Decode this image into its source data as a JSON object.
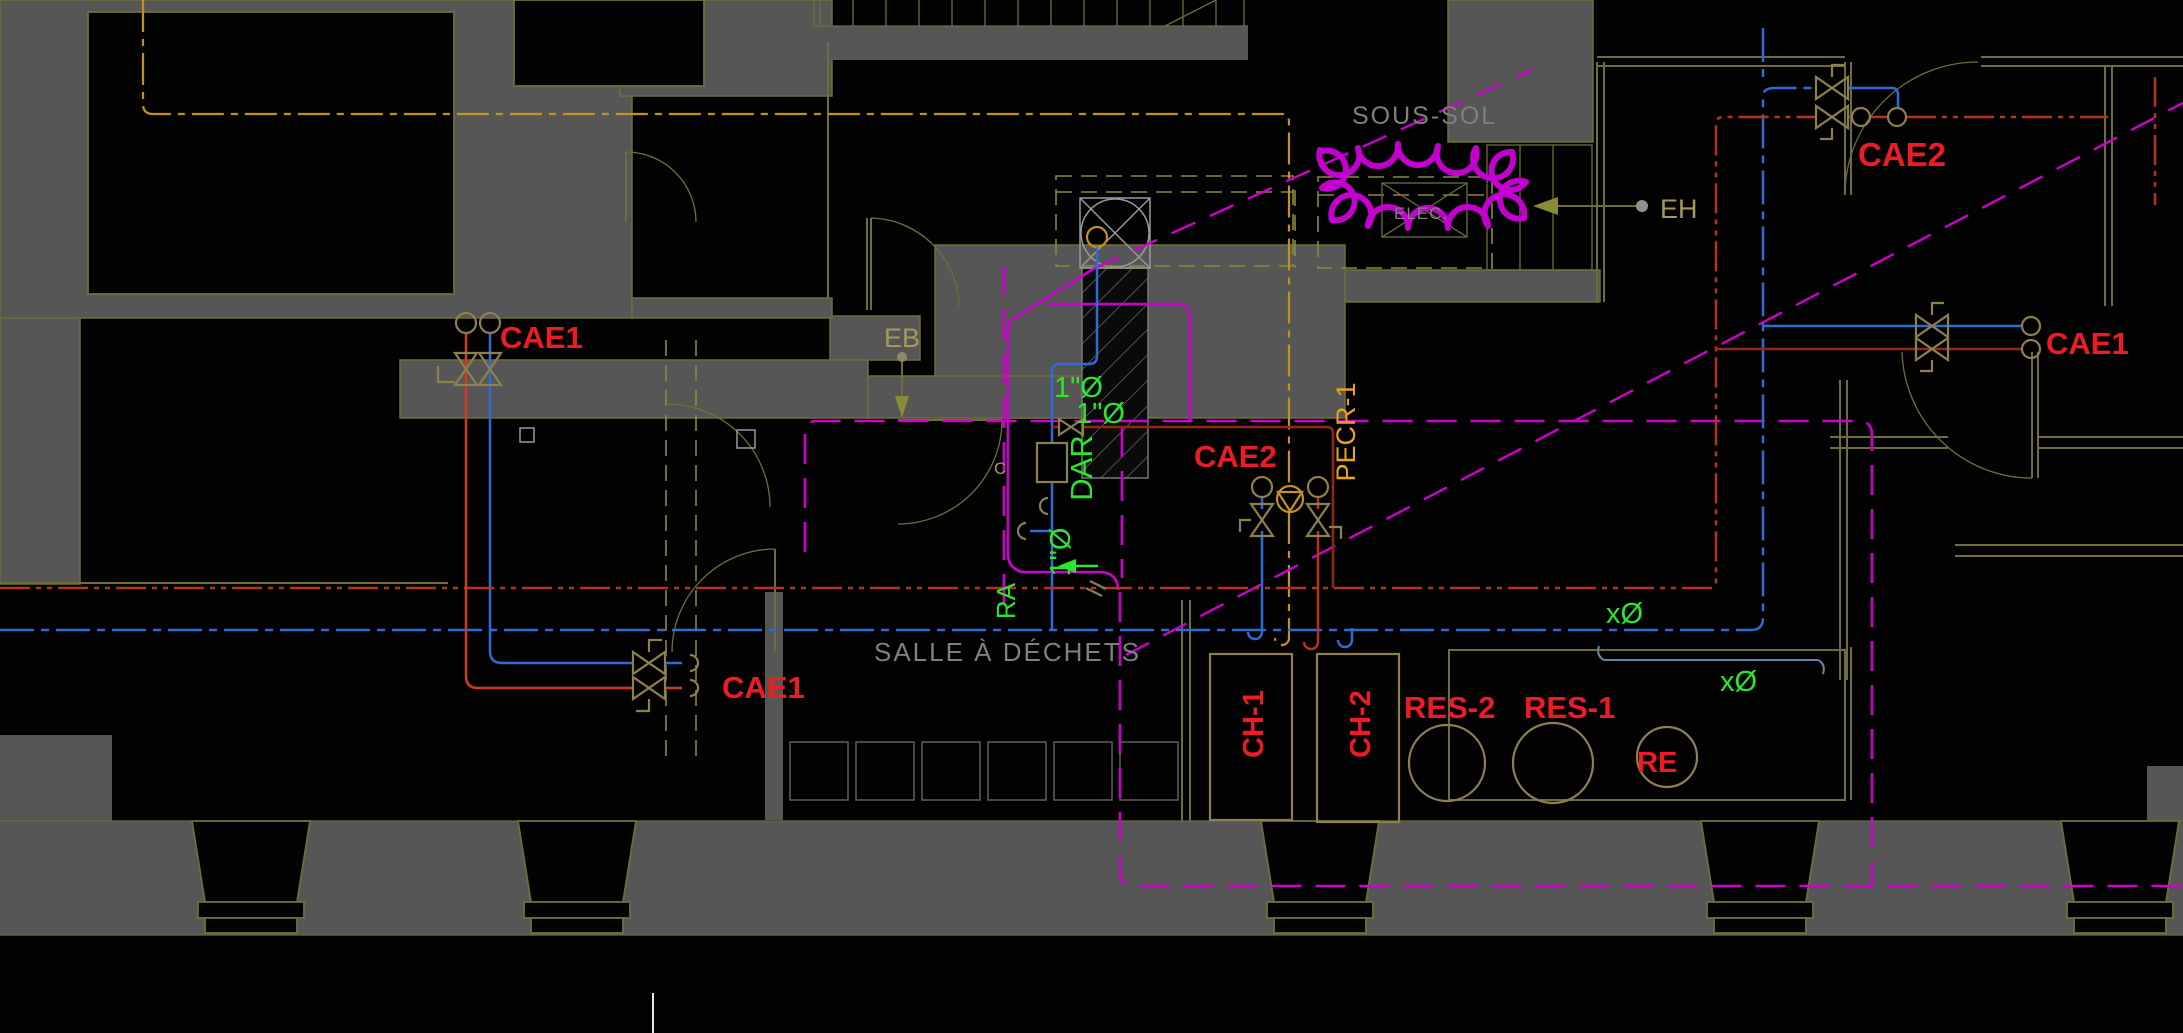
{
  "drawing": {
    "floor_label": "SOUS-SOL",
    "room_labels": {
      "elec": "ELEC.",
      "salle_a_dechets": "SALLE À DÉCHETS"
    },
    "point_labels": {
      "eb": "EB",
      "eh": "EH",
      "c_tag": "C"
    },
    "pipe_tags": {
      "cae1_upper_left": "CAE1",
      "cae1_lower_left": "CAE1",
      "cae1_right": "CAE1",
      "cae2_upper_right": "CAE2",
      "cae2_center": "CAE2",
      "pecr1": "PECR-1",
      "dar": "DAR",
      "ra": "RA"
    },
    "size_annotations": {
      "dia_1": "1\"Ø",
      "dia_2": "1\"Ø",
      "dia_3": "1\"Ø",
      "dia_x1": "xØ",
      "dia_x2": "xØ"
    },
    "equipment_tags": {
      "ch1": "CH-1",
      "ch2": "CH-2",
      "res2": "RES-2",
      "res1": "RES-1",
      "re": "RE"
    }
  },
  "colors": {
    "wall_fill": "#565656",
    "wall_line": "#6e6e3a",
    "equipment_line": "#8d8050",
    "tag_red": "#ed1c24",
    "pipe_red": "#b5341c",
    "pipe_red_dark": "#8f2913",
    "pipe_blue": "#2e6bd6",
    "pipe_orange": "#c3921e",
    "annotation_green": "#2ee52e",
    "zone_magenta": "#cf00cf",
    "cloud_magenta": "#c400d0",
    "text_gray": "#7f7f7f",
    "text_olive": "#a39a5a",
    "text_yellow": "#eaa417",
    "dim_steel": "#5f87a8",
    "white_line": "#e8e8e8"
  }
}
